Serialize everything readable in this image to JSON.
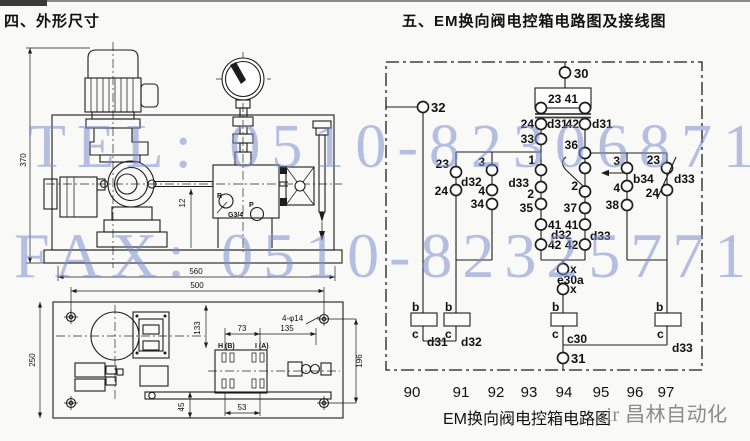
{
  "page": {
    "left_section_title": "四、外形尺寸",
    "right_section_title": "五、EM换向阀电控箱电路图及接线图",
    "circuit_caption": "EM换向阀电控箱电路图"
  },
  "watermarks": {
    "tel": "TEL: 0510-82306871",
    "fax": "FAX: 0510-82325771",
    "brand": "air 昌林自动化",
    "tel_fax_color": "#7a8ece",
    "brand_color": "#787878"
  },
  "dimension_drawing": {
    "side_view": {
      "height": "370",
      "shaft_offset": "12",
      "port_r": "R",
      "port_thread": "G3/4",
      "port_p": "P",
      "overall_length": "560",
      "hole_span": "500"
    },
    "plan_view": {
      "depth": "250",
      "dim_133": "133",
      "dim_73": "73",
      "dim_135": "135",
      "mounting_holes": "4-φ14",
      "dim_196": "196",
      "dim_45": "45",
      "dim_53": "53",
      "port_b": "H (B)",
      "port_a": "I (A)"
    }
  },
  "circuit": {
    "terminal_30": "30",
    "terminal_32": "32",
    "terminal_31": "31",
    "coil_box": "23 41",
    "n24": "24",
    "d31_left": "d31",
    "n42": "42",
    "d31_right": "d31",
    "n33": "33",
    "n36": "36",
    "left_branch": {
      "n23": "23",
      "d32": "d32",
      "n24": "24",
      "n3": "3",
      "n4": "4",
      "n34": "34"
    },
    "center": {
      "n1": "1",
      "d33": "d33",
      "n2": "2",
      "n35": "35",
      "n2r": "2",
      "n37": "37",
      "n41a": "41",
      "n41b": "41",
      "d32": "d32",
      "d33b": "d33",
      "n42a": "42",
      "n42b": "42",
      "x_top": "x",
      "e30a": "e30a",
      "x_bottom": "x"
    },
    "right_branch": {
      "n3": "3",
      "b34": "b34",
      "n4": "4",
      "n38": "38",
      "n23": "23",
      "d33": "d33",
      "n24": "24"
    },
    "boxes": {
      "b": "b",
      "c": "c",
      "d31": "d31",
      "d32": "d32",
      "c30": "c30",
      "d33": "d33"
    },
    "bottom_numbers": [
      "90",
      "91",
      "92",
      "93",
      "94",
      "95",
      "96",
      "97"
    ]
  }
}
